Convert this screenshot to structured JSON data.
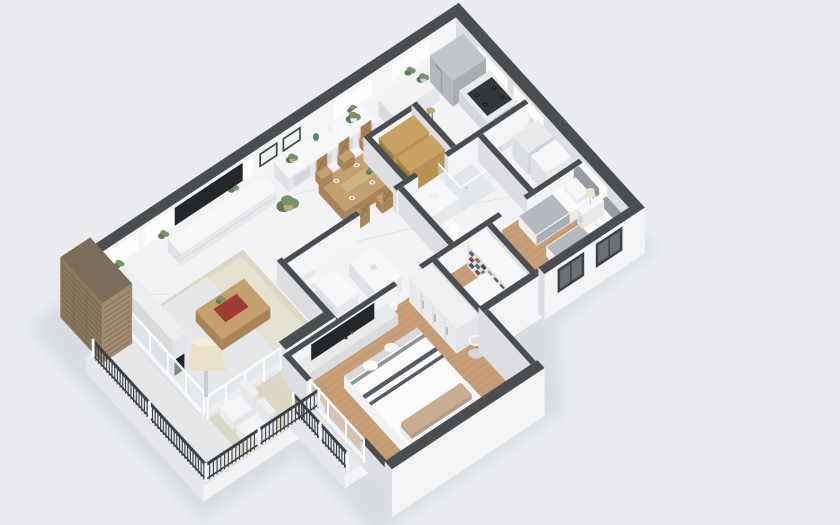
{
  "scene": {
    "label": "3D isometric floor plan render of a two-bedroom apartment with balconies",
    "background": "#e9ebee",
    "colors": {
      "shadow": "#ccd1d8",
      "wall_cap": "#4a4e51",
      "wall_face": "#f3f4f6",
      "wall_edge": "#dcdee1",
      "window_lit": "#fdfdfb",
      "glass": "#dfe9ee",
      "frame_white": "#fbfcfd",
      "floor_marble": "#f3f2f4",
      "marble_vein": "#c8ccd2",
      "floor_wood": "#c79e78",
      "floor_wood_line": "#b58a63",
      "rug": "#dcd7c4",
      "rug_inner": "#e6e2d1",
      "balcony_floor": "#e6e7e9",
      "slab_front": "#f2f3f5",
      "slab_side": "#e4e6e9",
      "railing": "#3e4246",
      "stone_top": "#7d6c5a",
      "stone_front": "#a18a71",
      "stone_side": "#8c775f",
      "stone_line": "#6d5a47",
      "steel_top": "#c2c6ca",
      "steel_front": "#a8adb2",
      "steel_side": "#b4b8bd",
      "steel_detail": "#8c9196",
      "appliance_dark": "#33363a",
      "burner_dark": "#17191b",
      "tv": "#24272a",
      "wood": "#c4a06e",
      "wood_dark": "#a9845a",
      "white_top": "#f6f7f8",
      "white_front": "#e6e8ea",
      "white_side": "#dfe1e4",
      "panel_line": "#cfd3d6",
      "counter_top": "#e9eaed",
      "counter_front": "#dfe1e4",
      "counter_side": "#d6d8db",
      "sink_steel": "#cdd0d4",
      "sink_inner": "#b9bdc2",
      "bedding_white": "#fbfbfc",
      "bedding_gray": "#b3b9bf",
      "blanket_edge": "#a9afb6",
      "stripe_dark": "#565b60",
      "pillow_tan": "#c8ad92",
      "headboard_gray": "#969ca4",
      "headboard_gray_dark": "#878d94",
      "plant": "#76936b",
      "plant_dark": "#5d7a52",
      "pot_tan": "#c9a87c",
      "accent_red": "#9d3b34",
      "lamp_shade": "#e9e1c9",
      "gold_shelf_top": "#c7a263",
      "gold_shelf_front": "#b8924f",
      "gold_shelf_side": "#a9854a",
      "gold_shelf_line": "#8a6a36",
      "clothes": [
        "#44536e",
        "#8a4a44",
        "#5d6b82",
        "#97724f",
        "#3d4758",
        "#8f96a0"
      ]
    },
    "rooms": [
      {
        "id": "living-room",
        "features": [
          "wall-tv",
          "tv-console",
          "fireplace",
          "area-rug",
          "coffee-table",
          "floor-lamp",
          "potted-plant",
          "glass-wall"
        ]
      },
      {
        "id": "dining-area",
        "features": [
          "sideboard",
          "dining-table",
          "dining-chairs",
          "picture-frames",
          "bar-counter",
          "bar-stools"
        ]
      },
      {
        "id": "kitchen",
        "features": [
          "refrigerator",
          "range-cooktop",
          "kitchen-sink",
          "kitchen-counter"
        ]
      },
      {
        "id": "pantry",
        "features": [
          "pantry-shelves"
        ]
      },
      {
        "id": "laundry-nook",
        "features": [
          "washer",
          "laundry-counter"
        ]
      },
      {
        "id": "bathroom",
        "features": [
          "shower",
          "toilet",
          "vanity-sink"
        ]
      },
      {
        "id": "ensuite-bathroom",
        "features": [
          "toilet",
          "vanity-sink",
          "storage-cabinet"
        ]
      },
      {
        "id": "bedroom",
        "features": [
          "twin-bed",
          "twin-bed",
          "nightstand",
          "table-lamp",
          "windows"
        ]
      },
      {
        "id": "walk-in-closet",
        "features": [
          "closet-shelves",
          "folded-clothes"
        ]
      },
      {
        "id": "master-bedroom",
        "features": [
          "master-bed",
          "pillows",
          "headboard",
          "media-console",
          "wall-tv",
          "wardrobe",
          "laundry-hamper"
        ]
      },
      {
        "id": "balcony",
        "features": [
          "balcony-railing",
          "lounge-chairs",
          "outdoor-rug"
        ]
      },
      {
        "id": "juliet-balcony",
        "features": [
          "balcony-railing",
          "glass-door"
        ]
      }
    ],
    "exterior": [
      "stone-chimney",
      "window-wall",
      "dark-wall-caps",
      "white-facade"
    ]
  }
}
